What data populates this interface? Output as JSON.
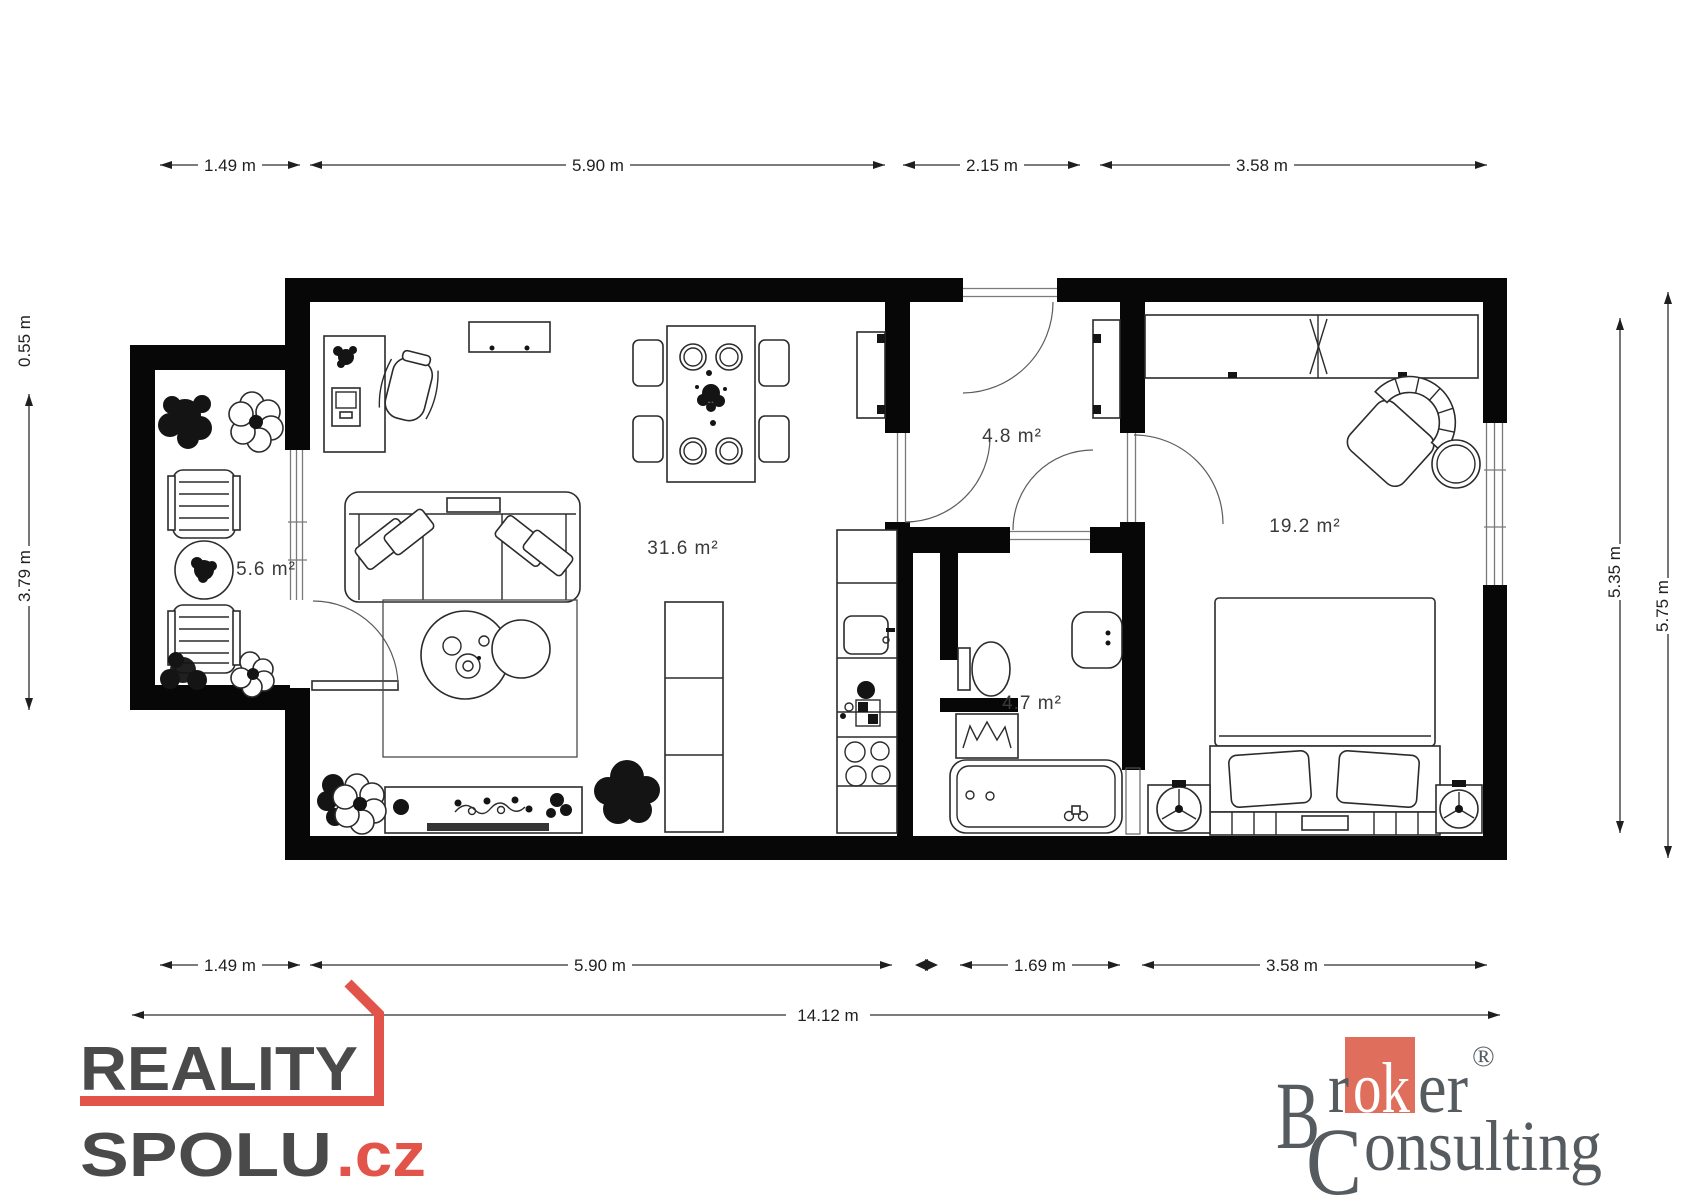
{
  "floorplan": {
    "rooms": {
      "living": {
        "area_label": "31.6 m²"
      },
      "hall": {
        "area_label": "4.8 m²"
      },
      "bathroom": {
        "area_label": "4.7 m²"
      },
      "bedroom": {
        "area_label": "19.2 m²"
      },
      "balcony": {
        "area_label": "5.6 m²"
      }
    },
    "dimensions": {
      "top": [
        "1.49 m",
        "5.90 m",
        "2.15 m",
        "3.58 m"
      ],
      "bottom": [
        "1.49 m",
        "5.90 m",
        "1.69 m",
        "3.58 m"
      ],
      "total": "14.12 m",
      "left_offset": "0.55 m",
      "left_height": "3.79 m",
      "right_inner": "5.35 m",
      "right_outer": "5.75 m"
    },
    "colors": {
      "wall": "#070707",
      "furniture_stroke": "#2b2b2b"
    }
  },
  "branding": {
    "reality_spolu": {
      "line1": "REALITY",
      "line2": "SPOLU",
      "tld": ".cz",
      "accent_color": "#e2544a",
      "text_color": "#4a4a4a"
    },
    "broker_consulting": {
      "initial_b": "B",
      "frag_r": "r",
      "frag_ok": "ok",
      "frag_er": "er",
      "registered": "®",
      "initial_c": "C",
      "frag_onsulting": "onsulting",
      "square_color": "#df6f5c",
      "text_color": "#565b60"
    }
  }
}
